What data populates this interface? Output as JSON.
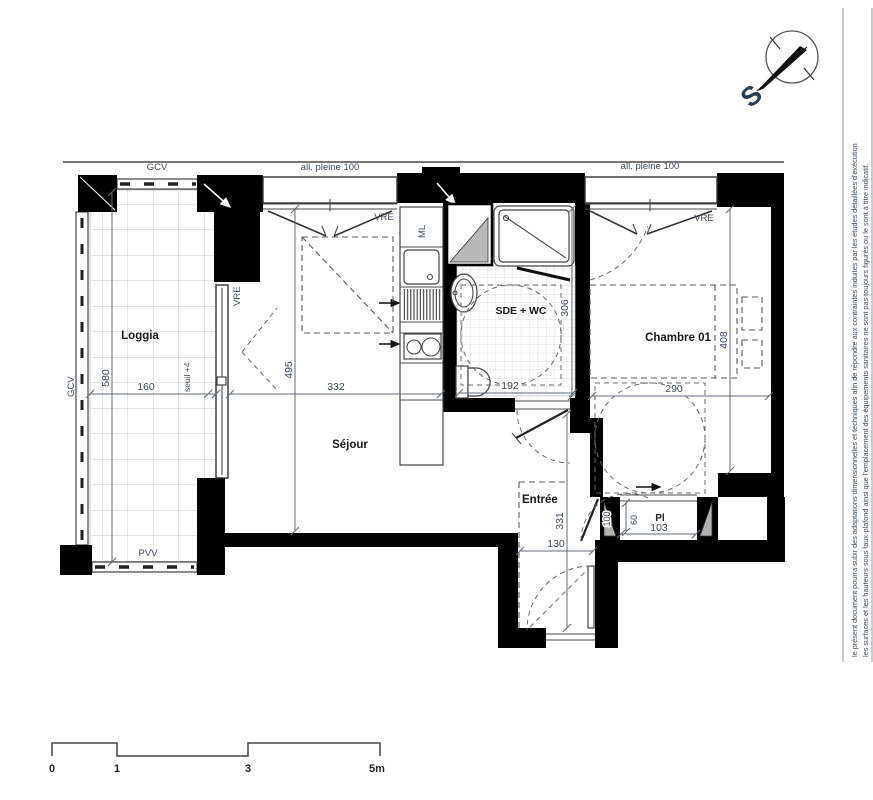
{
  "meta": {
    "type": "architectural-floor-plan",
    "colors": {
      "wall": "#000000",
      "line": "#4a4a4a",
      "annotation_text": "#3d4a5c",
      "room_label": "#191919",
      "tile_grid": "#c9c9c9",
      "column_fill": "#b2b2b2"
    }
  },
  "compass": {
    "south_label": "S"
  },
  "disclaimer": {
    "line1": "le présent document pourra subir des adaptations dimensionnelles et techniques afin de répondre aux contraintes induites par les études détaillées d'exécution",
    "line2": "les surfaces et les hauteurs sous faux-plafond ainsi que l'emplacement des équipements sanitaires ne sont pas toujours figurés ou le sont à titre indicatif."
  },
  "rooms": {
    "loggia": "Loggia",
    "sejour": "Séjour",
    "sde_wc": "SDE + WC",
    "chambre": "Chambre 01",
    "entree": "Entrée",
    "placard": "Pl"
  },
  "openings": {
    "all_pleine_1": "all. pleine 100",
    "all_pleine_2": "all. pleine 100",
    "vre_window_1": "VRE",
    "vre_window_2": "VRE",
    "vre_loggia_door": "VRE",
    "gcv_top": "GCV",
    "gcv_left": "GCV",
    "pvv": "PVV",
    "ml": "ML"
  },
  "dims": {
    "loggia_depth": "580",
    "loggia_width": "160",
    "sejour_depth": "495",
    "sejour_width": "332",
    "sde_width": "192",
    "sde_depth": "306",
    "chambre_width": "290",
    "chambre_depth": "408",
    "entree_depth": "331",
    "vestibule_width": "130",
    "placard_depth": "60",
    "placard_width": "103",
    "door_width": "100",
    "seuil": "seuil +4"
  },
  "scale_bar": {
    "t0": "0",
    "t1": "1",
    "t3": "3",
    "t5": "5m"
  }
}
